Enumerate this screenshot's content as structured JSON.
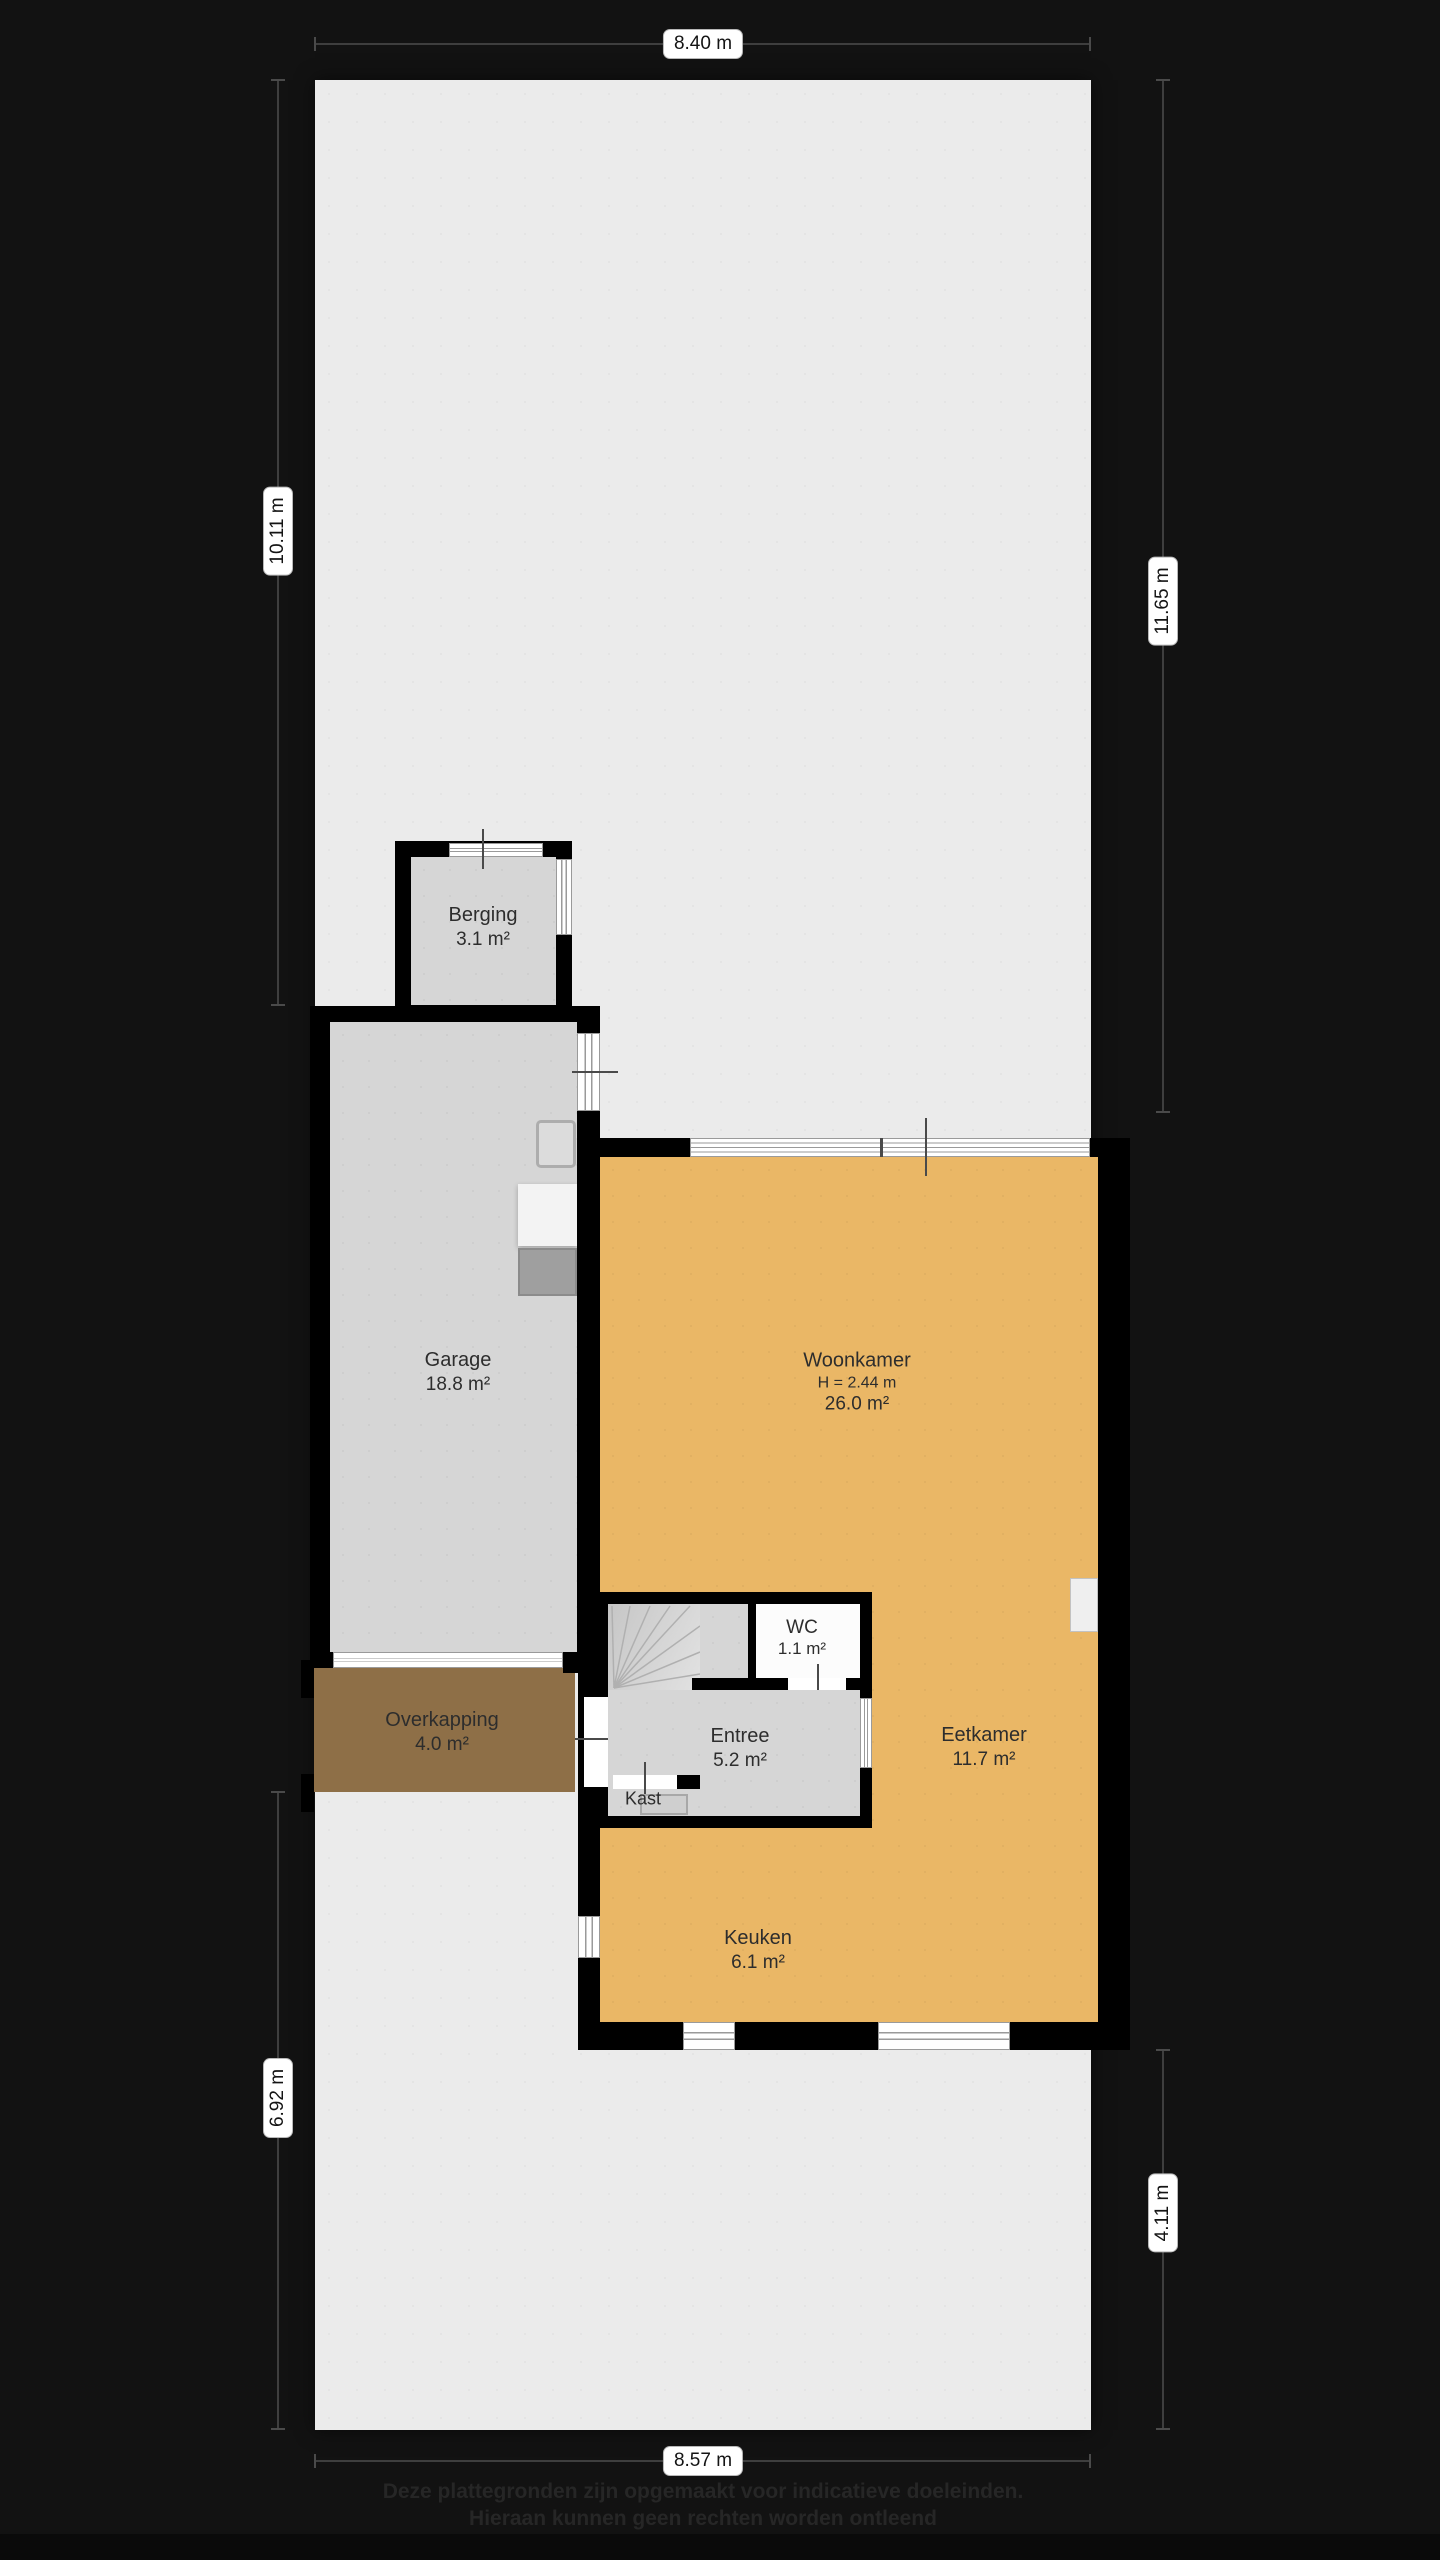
{
  "plan": {
    "rooms": [
      {
        "name": "Berging",
        "area": "3.1 m²"
      },
      {
        "name": "Garage",
        "area": "18.8 m²"
      },
      {
        "name": "Woonkamer",
        "height": "H = 2.44 m",
        "area": "26.0 m²"
      },
      {
        "name": "WC",
        "area": "1.1 m²"
      },
      {
        "name": "Entree",
        "area": "5.2 m²"
      },
      {
        "name": "Kast"
      },
      {
        "name": "Eetkamer",
        "area": "11.7 m²"
      },
      {
        "name": "Keuken",
        "area": "6.1 m²"
      },
      {
        "name": "Overkapping",
        "area": "4.0 m²"
      }
    ],
    "dimensions": {
      "top": "8.40 m",
      "bottom": "8.57 m",
      "left_upper": "10.11 m",
      "left_lower": "6.92 m",
      "right_upper": "11.65 m",
      "right_lower": "4.11 m"
    },
    "footer": {
      "line1": "Deze plattegronden zijn opgemaakt voor indicatieve doeleinden.",
      "line2": "Hieraan kunnen geen rechten worden ontleend"
    },
    "colors": {
      "background": "#121212",
      "plot": "#ebebeb",
      "floor_gray": "#d6d6d6",
      "floor_orange": "#eab766",
      "floor_brown": "#8e6f47",
      "wall": "#000000",
      "wc_floor": "#fcfcfc"
    }
  }
}
